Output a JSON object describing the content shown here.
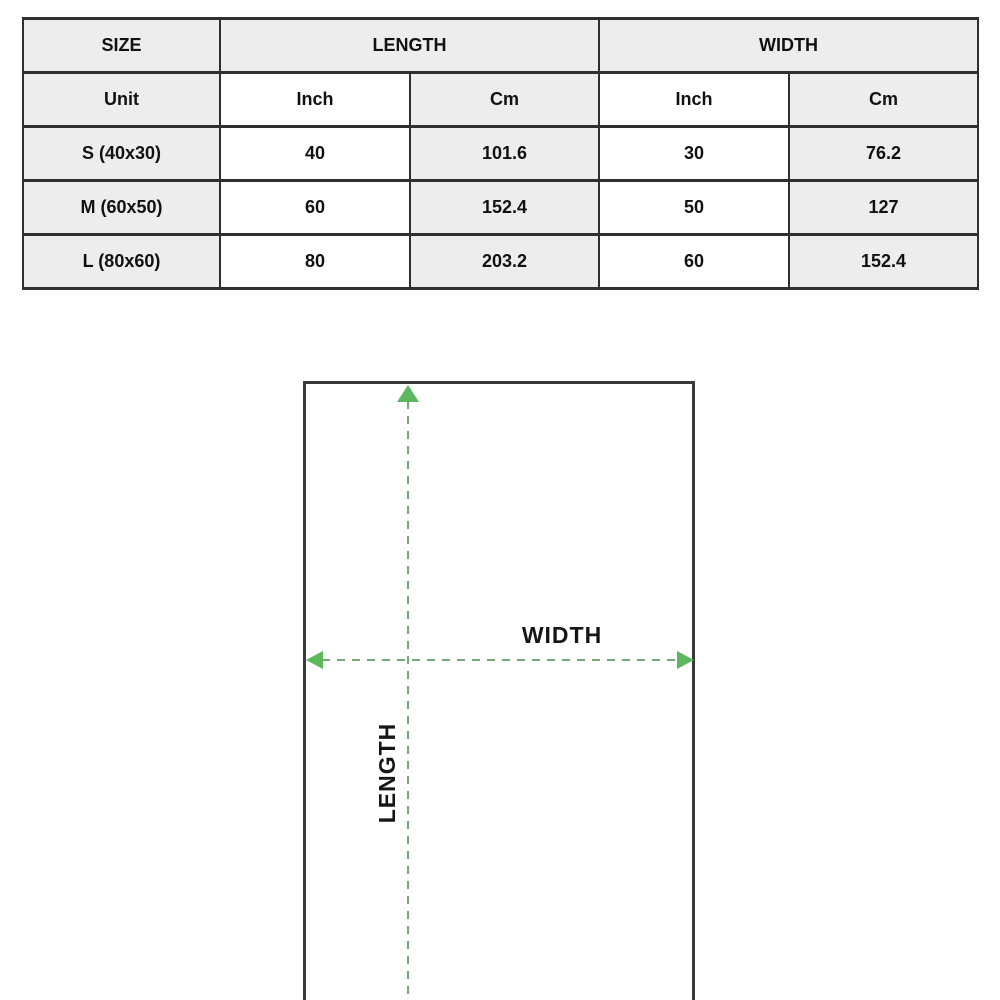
{
  "table": {
    "headers": {
      "size": "SIZE",
      "length": "LENGTH",
      "width": "WIDTH"
    },
    "unit_row": {
      "label": "Unit",
      "length_inch": "Inch",
      "length_cm": "Cm",
      "width_inch": "Inch",
      "width_cm": "Cm"
    },
    "rows": [
      {
        "size": "S (40x30)",
        "length_inch": "40",
        "length_cm": "101.6",
        "width_inch": "30",
        "width_cm": "76.2"
      },
      {
        "size": "M (60x50)",
        "length_inch": "60",
        "length_cm": "152.4",
        "width_inch": "50",
        "width_cm": "127"
      },
      {
        "size": "L (80x60)",
        "length_inch": "80",
        "length_cm": "203.2",
        "width_inch": "60",
        "width_cm": "152.4"
      }
    ]
  },
  "diagram": {
    "width_label": "WIDTH",
    "length_label": "LENGTH",
    "arrow_color": "#5cb85c",
    "dash_color": "#74a97a",
    "outline_color": "#3a3a3a"
  },
  "colors": {
    "cell_gray": "#ededed",
    "table_border": "#2f2f2f",
    "text": "#111111"
  }
}
